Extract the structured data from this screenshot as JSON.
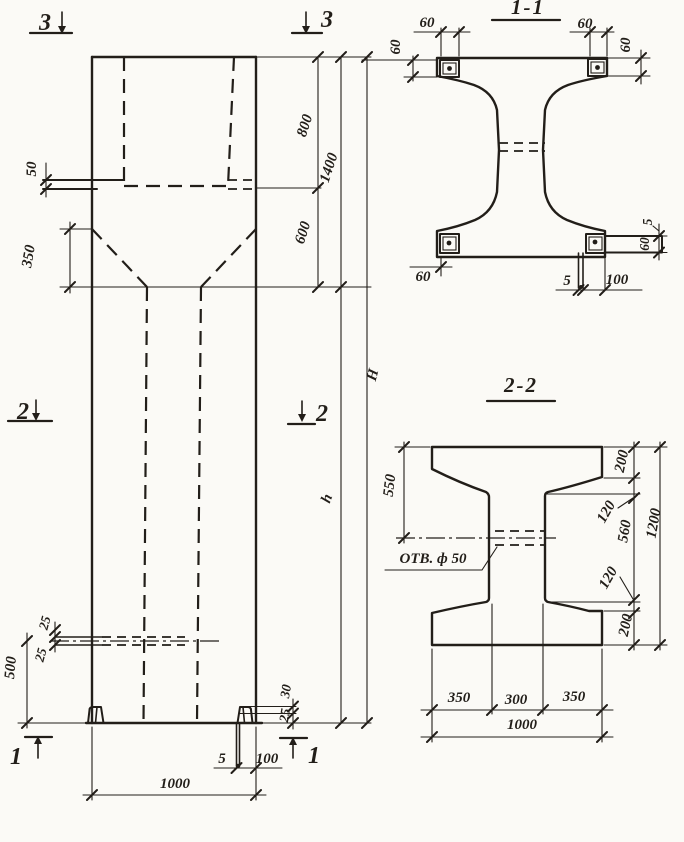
{
  "elevation": {
    "markers": {
      "top_left": "3",
      "top_right": "3",
      "mid_left": "2",
      "mid_right": "2",
      "bottom_left": "1",
      "bottom_right": "1"
    },
    "dims": {
      "ledge": "50",
      "taper": "350",
      "top": "800",
      "head": "1400",
      "neck": "600",
      "overall": "H",
      "shaft": "h",
      "slot_a": "25",
      "slot_b": "25",
      "base": "500",
      "foot_a": "30",
      "foot_b": "25",
      "anchor_t": "5",
      "anchor_l": "100",
      "width": "1000"
    }
  },
  "section_1_1": {
    "title": "1-1",
    "dims": {
      "tl_w": "60",
      "tl_h": "60",
      "tr_w": "60",
      "tr_h": "60",
      "bl_w": "60",
      "bar_gap": "5",
      "bar_h": "60",
      "plate_t": "5",
      "bar_l": "100"
    }
  },
  "section_2_2": {
    "title": "2-2",
    "hole_label": "ОТВ. ф 50",
    "dims": {
      "top_to_hole": "550",
      "flange_top": "200",
      "haunch_top": "120",
      "web": "560",
      "overall": "1200",
      "haunch_bot": "120",
      "flange_bot": "200",
      "left": "350",
      "mid": "300",
      "right": "350",
      "width": "1000"
    }
  }
}
